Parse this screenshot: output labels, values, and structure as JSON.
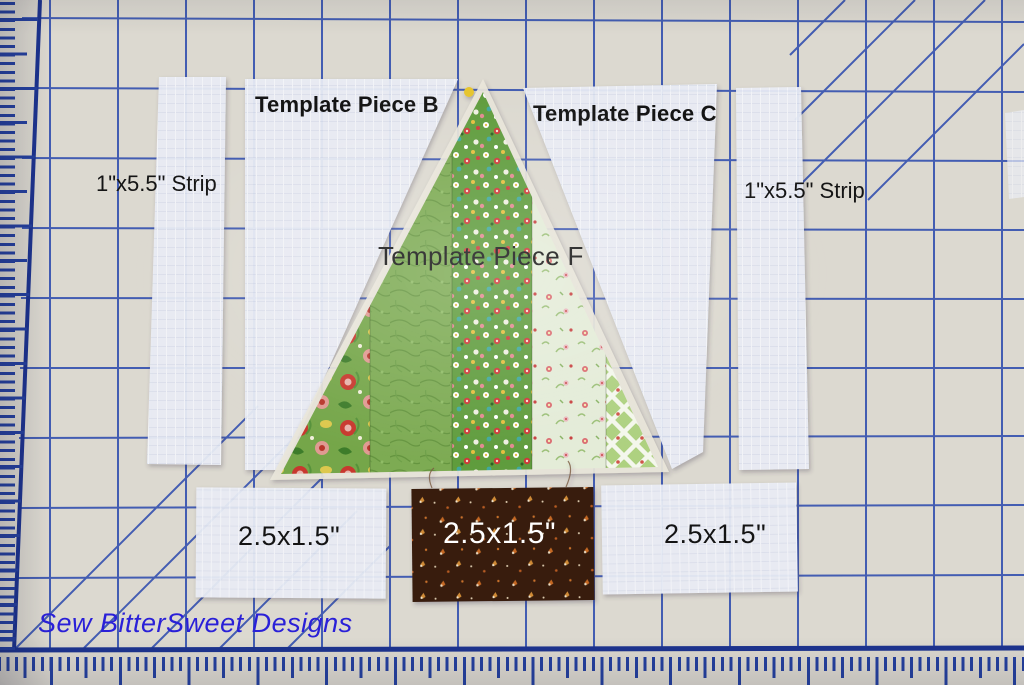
{
  "labels": {
    "template_piece_b": "Template Piece B",
    "template_piece_c": "Template Piece C",
    "template_piece_f": "Template Piece F",
    "strip_left": "1\"x5.5\" Strip",
    "strip_right": "1\"x5.5\" Strip",
    "rect_bottom_left": "2.5x1.5\"",
    "rect_bottom_center": "2.5x1.5\"",
    "rect_bottom_right": "2.5x1.5\"",
    "watermark": "Sew BitterSweet Designs"
  },
  "colors": {
    "mat": "#dcd9d0",
    "grid_blue": "#2f4cae",
    "ruler_blue": "#24409f",
    "label_text": "#141414",
    "trunk_label_text": "#ffffff",
    "watermark_blue": "#2a20d8",
    "background_fabric_white": "#eaedf5",
    "tree_strip_greens": [
      "#74a648",
      "#7dab52",
      "#5e9c3c",
      "#e4ecd8",
      "#aed180"
    ],
    "trunk_brown": "#371f10"
  }
}
